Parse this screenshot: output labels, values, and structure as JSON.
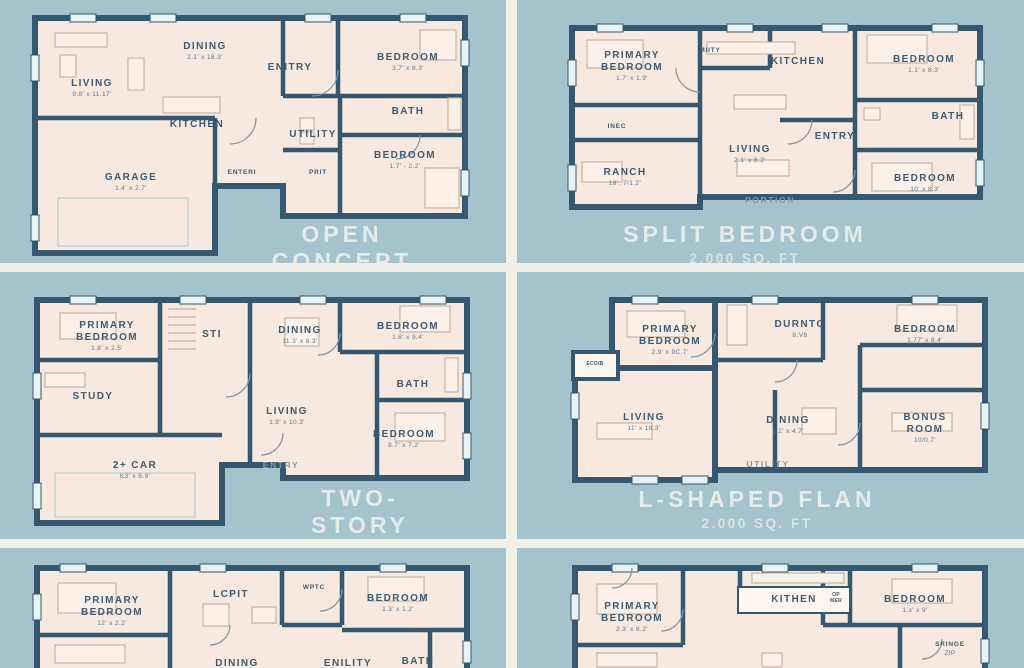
{
  "palette": {
    "bg": "#a5c3cc",
    "wall": "#35576f",
    "floor": "#f7e9df",
    "divider": "#f2efe6",
    "label": "#3d5b74",
    "title": "#e3ece8"
  },
  "plans": [
    {
      "id": "open-concept",
      "title": "OPEN CONCEPT",
      "sqft": "2,000 SQ. FT",
      "rooms": [
        {
          "name": "LIVING",
          "dims": "9.8' x 11.17'"
        },
        {
          "name": "DINING",
          "dims": "2.1' x 18.3'"
        },
        {
          "name": "KITCHEN",
          "dims": ""
        },
        {
          "name": "ENITRY",
          "dims": ""
        },
        {
          "name": "BEDROOM",
          "dims": "3.7' x 8.3'"
        },
        {
          "name": "BATH",
          "dims": ""
        },
        {
          "name": "UTILITY",
          "dims": ""
        },
        {
          "name": "BEDROOM",
          "dims": "1.7' - 2.2'"
        },
        {
          "name": "GARAGE",
          "dims": "1.4' x 2.7'"
        },
        {
          "name": "ENTERI",
          "dims": ""
        },
        {
          "name": "PRIT",
          "dims": ""
        }
      ]
    },
    {
      "id": "split-bedroom",
      "title": "SPLIT BEDROOM",
      "sqft": "2,000 SQ. FT",
      "rooms": [
        {
          "name": "PRIMARY\nBEDROOM",
          "dims": "1.7' x 1.9'"
        },
        {
          "name": "MIITY",
          "dims": ""
        },
        {
          "name": "KITCHEN",
          "dims": ""
        },
        {
          "name": "BEDROOM",
          "dims": "1.1' x 8.3'"
        },
        {
          "name": "INEC",
          "dims": ""
        },
        {
          "name": "LIVING",
          "dims": "2.1' x 8.2'"
        },
        {
          "name": "ENTRY",
          "dims": ""
        },
        {
          "name": "BATH",
          "dims": ""
        },
        {
          "name": "RANCH",
          "dims": "18'. 7/1.2'"
        },
        {
          "name": "BEDROOM",
          "dims": "10' x 8.3'"
        },
        {
          "name": "PORTION",
          "dims": ""
        }
      ]
    },
    {
      "id": "two-story",
      "title": "TWO-STORY",
      "sqft": "2,000 SQ. FT",
      "rooms": [
        {
          "name": "PRIMARY\nBEDROOM",
          "dims": "1.8' x 2.5'"
        },
        {
          "name": "STI",
          "dims": ""
        },
        {
          "name": "DINING",
          "dims": "11.3' x 8.3'"
        },
        {
          "name": "BEDROOM",
          "dims": "1.8' x 9.4'"
        },
        {
          "name": "STUDY",
          "dims": ""
        },
        {
          "name": "LIVING",
          "dims": "1.9' x 10.3'"
        },
        {
          "name": "BATH",
          "dims": ""
        },
        {
          "name": "BEDROOM",
          "dims": "8.7' x 7.2'"
        },
        {
          "name": "2+ CAR",
          "dims": "K3' x 8.9'"
        },
        {
          "name": "ENTRY",
          "dims": ""
        }
      ]
    },
    {
      "id": "l-shaped",
      "title": "L-SHAPED FLAN",
      "sqft": "2.000 SQ. FT",
      "rooms": [
        {
          "name": "PRIMARY\nBEDROOM",
          "dims": "2.9' x 9C.7'"
        },
        {
          "name": "ECOIB",
          "dims": ""
        },
        {
          "name": "DURNTO",
          "dims": "8.V8"
        },
        {
          "name": "BEDROOM",
          "dims": "1.77' x 8.4'"
        },
        {
          "name": "LIVING",
          "dims": "11' x 18.3'"
        },
        {
          "name": "DINING",
          "dims": "1.2' x 4.7'"
        },
        {
          "name": "BONUS\nROOM",
          "dims": "10/0.7'"
        },
        {
          "name": "UTILITY",
          "dims": ""
        }
      ]
    },
    {
      "id": "bottom-left",
      "title": "",
      "sqft": "",
      "rooms": [
        {
          "name": "PRIMARY\nBEDROOM",
          "dims": "12' x 2.2'"
        },
        {
          "name": "LCPIT",
          "dims": ""
        },
        {
          "name": "WPTC",
          "dims": ""
        },
        {
          "name": "BEDROOM",
          "dims": "1.3' x 1.2'"
        },
        {
          "name": "DINING",
          "dims": ""
        },
        {
          "name": "ENILITY",
          "dims": ""
        },
        {
          "name": "BATH",
          "dims": ""
        }
      ]
    },
    {
      "id": "bottom-right",
      "title": "",
      "sqft": "",
      "rooms": [
        {
          "name": "PRIMARY\nBEDROOM",
          "dims": "2.3' x 8.2'"
        },
        {
          "name": "KITHEN",
          "dims": ""
        },
        {
          "name": "OP\nMER",
          "dims": ""
        },
        {
          "name": "BEDROOM",
          "dims": "1.x' x 9'"
        },
        {
          "name": "SRINGE",
          "dims": "ZIP"
        }
      ]
    }
  ]
}
